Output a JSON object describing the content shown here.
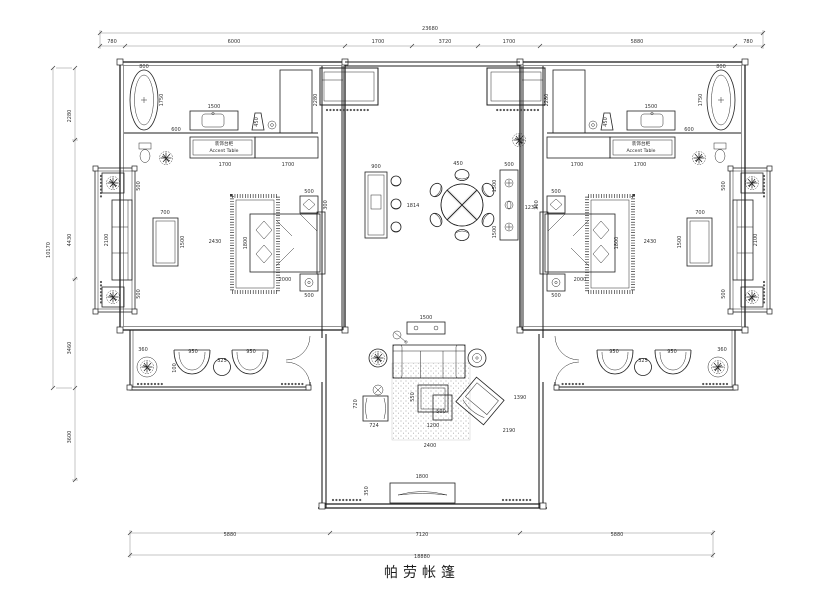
{
  "title": "帕劳帐篷",
  "drawing": {
    "type": "architectural-floor-plan",
    "style": "CAD line drawing, black on white, symmetric twin-bedroom tent villa"
  },
  "furniture_labels": {
    "accent_table_cn": "装饰台柜",
    "accent_table_en": "Accent Table"
  },
  "dimensions": {
    "top_total": "23680",
    "top_segments": [
      "780",
      "6000",
      "1700",
      "3720",
      "1700",
      "5880",
      "780"
    ],
    "bottom_segments": [
      "5880",
      "7120",
      "5880"
    ],
    "bottom_total": "18880",
    "left_segments": [
      "2280",
      "4430",
      "3460",
      "3600"
    ],
    "left_total": "10170"
  },
  "annotations": [
    {
      "t": "23680",
      "x": 430,
      "y": 30
    },
    {
      "t": "780",
      "x": 112,
      "y": 43
    },
    {
      "t": "6000",
      "x": 234,
      "y": 43
    },
    {
      "t": "1700",
      "x": 378,
      "y": 43
    },
    {
      "t": "3720",
      "x": 445,
      "y": 43
    },
    {
      "t": "1700",
      "x": 509,
      "y": 43
    },
    {
      "t": "5880",
      "x": 637,
      "y": 43
    },
    {
      "t": "780",
      "x": 748,
      "y": 43
    },
    {
      "t": "5880",
      "x": 230,
      "y": 536
    },
    {
      "t": "7120",
      "x": 422,
      "y": 536
    },
    {
      "t": "5880",
      "x": 617,
      "y": 536
    },
    {
      "t": "18880",
      "x": 422,
      "y": 558
    },
    {
      "t": "2280",
      "x": 71,
      "y": 116,
      "r": -90
    },
    {
      "t": "4430",
      "x": 71,
      "y": 240,
      "r": -90
    },
    {
      "t": "3460",
      "x": 71,
      "y": 348,
      "r": -90
    },
    {
      "t": "3600",
      "x": 71,
      "y": 437,
      "r": -90
    },
    {
      "t": "10170",
      "x": 50,
      "y": 250,
      "r": -90
    },
    {
      "t": "800",
      "x": 144,
      "y": 68
    },
    {
      "t": "1750",
      "x": 163,
      "y": 100,
      "r": -90
    },
    {
      "t": "1500",
      "x": 214,
      "y": 108
    },
    {
      "t": "600",
      "x": 176,
      "y": 131
    },
    {
      "t": "450",
      "x": 258,
      "y": 122,
      "r": -90
    },
    {
      "t": "2280",
      "x": 317,
      "y": 100,
      "r": -90
    },
    {
      "t": "800",
      "x": 721,
      "y": 68
    },
    {
      "t": "1750",
      "x": 702,
      "y": 100,
      "r": -90
    },
    {
      "t": "1500",
      "x": 651,
      "y": 108
    },
    {
      "t": "600",
      "x": 689,
      "y": 131
    },
    {
      "t": "450",
      "x": 607,
      "y": 122,
      "r": -90
    },
    {
      "t": "2280",
      "x": 548,
      "y": 100,
      "r": -90
    },
    {
      "t": "1700",
      "x": 225,
      "y": 166
    },
    {
      "t": "1700",
      "x": 288,
      "y": 166
    },
    {
      "t": "1700",
      "x": 577,
      "y": 166
    },
    {
      "t": "1700",
      "x": 640,
      "y": 166
    },
    {
      "t": "装饰台柜",
      "x": 224,
      "y": 145,
      "c": "lbl",
      "n": "accent-table-label-cn-left"
    },
    {
      "t": "Accent Table",
      "x": 224,
      "y": 152,
      "c": "lbl",
      "n": "accent-table-label-en-left"
    },
    {
      "t": "装饰台柜",
      "x": 641,
      "y": 145,
      "c": "lbl",
      "n": "accent-table-label-cn-right"
    },
    {
      "t": "Accent Table",
      "x": 641,
      "y": 152,
      "c": "lbl",
      "n": "accent-table-label-en-right"
    },
    {
      "t": "500",
      "x": 309,
      "y": 193
    },
    {
      "t": "300",
      "x": 327,
      "y": 205,
      "r": -90
    },
    {
      "t": "2430",
      "x": 215,
      "y": 243
    },
    {
      "t": "1800",
      "x": 247,
      "y": 243,
      "r": -90
    },
    {
      "t": "2000",
      "x": 285,
      "y": 281
    },
    {
      "t": "500",
      "x": 309,
      "y": 297
    },
    {
      "t": "700",
      "x": 165,
      "y": 214
    },
    {
      "t": "1500",
      "x": 184,
      "y": 242,
      "r": -90
    },
    {
      "t": "500",
      "x": 556,
      "y": 193
    },
    {
      "t": "300",
      "x": 538,
      "y": 205,
      "r": -90
    },
    {
      "t": "2430",
      "x": 650,
      "y": 243
    },
    {
      "t": "1800",
      "x": 618,
      "y": 243,
      "r": -90
    },
    {
      "t": "2000",
      "x": 580,
      "y": 281
    },
    {
      "t": "500",
      "x": 556,
      "y": 297
    },
    {
      "t": "700",
      "x": 700,
      "y": 214
    },
    {
      "t": "1500",
      "x": 681,
      "y": 242,
      "r": -90
    },
    {
      "t": "2100",
      "x": 108,
      "y": 240,
      "r": -90
    },
    {
      "t": "500",
      "x": 140,
      "y": 186,
      "r": -90
    },
    {
      "t": "500",
      "x": 140,
      "y": 294,
      "r": -90
    },
    {
      "t": "2100",
      "x": 757,
      "y": 240,
      "r": -90
    },
    {
      "t": "500",
      "x": 725,
      "y": 186,
      "r": -90
    },
    {
      "t": "500",
      "x": 725,
      "y": 294,
      "r": -90
    },
    {
      "t": "900",
      "x": 376,
      "y": 168
    },
    {
      "t": "1814",
      "x": 413,
      "y": 207
    },
    {
      "t": "450",
      "x": 458,
      "y": 165
    },
    {
      "t": "1234",
      "x": 531,
      "y": 209
    },
    {
      "t": "500",
      "x": 509,
      "y": 166
    },
    {
      "t": "1500",
      "x": 496,
      "y": 186,
      "r": -90
    },
    {
      "t": "1500",
      "x": 496,
      "y": 232,
      "r": -90
    },
    {
      "t": "360",
      "x": 143,
      "y": 351
    },
    {
      "t": "950",
      "x": 193,
      "y": 353
    },
    {
      "t": "950",
      "x": 251,
      "y": 353
    },
    {
      "t": "325",
      "x": 222,
      "y": 362
    },
    {
      "t": "100",
      "x": 176,
      "y": 368,
      "r": -90
    },
    {
      "t": "360",
      "x": 722,
      "y": 351
    },
    {
      "t": "950",
      "x": 672,
      "y": 353
    },
    {
      "t": "950",
      "x": 614,
      "y": 353
    },
    {
      "t": "325",
      "x": 643,
      "y": 362
    },
    {
      "t": "1500",
      "x": 426,
      "y": 319
    },
    {
      "t": "720",
      "x": 357,
      "y": 404,
      "r": -90
    },
    {
      "t": "724",
      "x": 374,
      "y": 427
    },
    {
      "t": "550",
      "x": 414,
      "y": 397,
      "r": -90
    },
    {
      "t": "500",
      "x": 441,
      "y": 413
    },
    {
      "t": "1200",
      "x": 433,
      "y": 427
    },
    {
      "t": "2400",
      "x": 430,
      "y": 447
    },
    {
      "t": "1390",
      "x": 520,
      "y": 399
    },
    {
      "t": "2190",
      "x": 509,
      "y": 432
    },
    {
      "t": "1800",
      "x": 422,
      "y": 478
    },
    {
      "t": "350",
      "x": 368,
      "y": 491,
      "r": -90
    }
  ]
}
